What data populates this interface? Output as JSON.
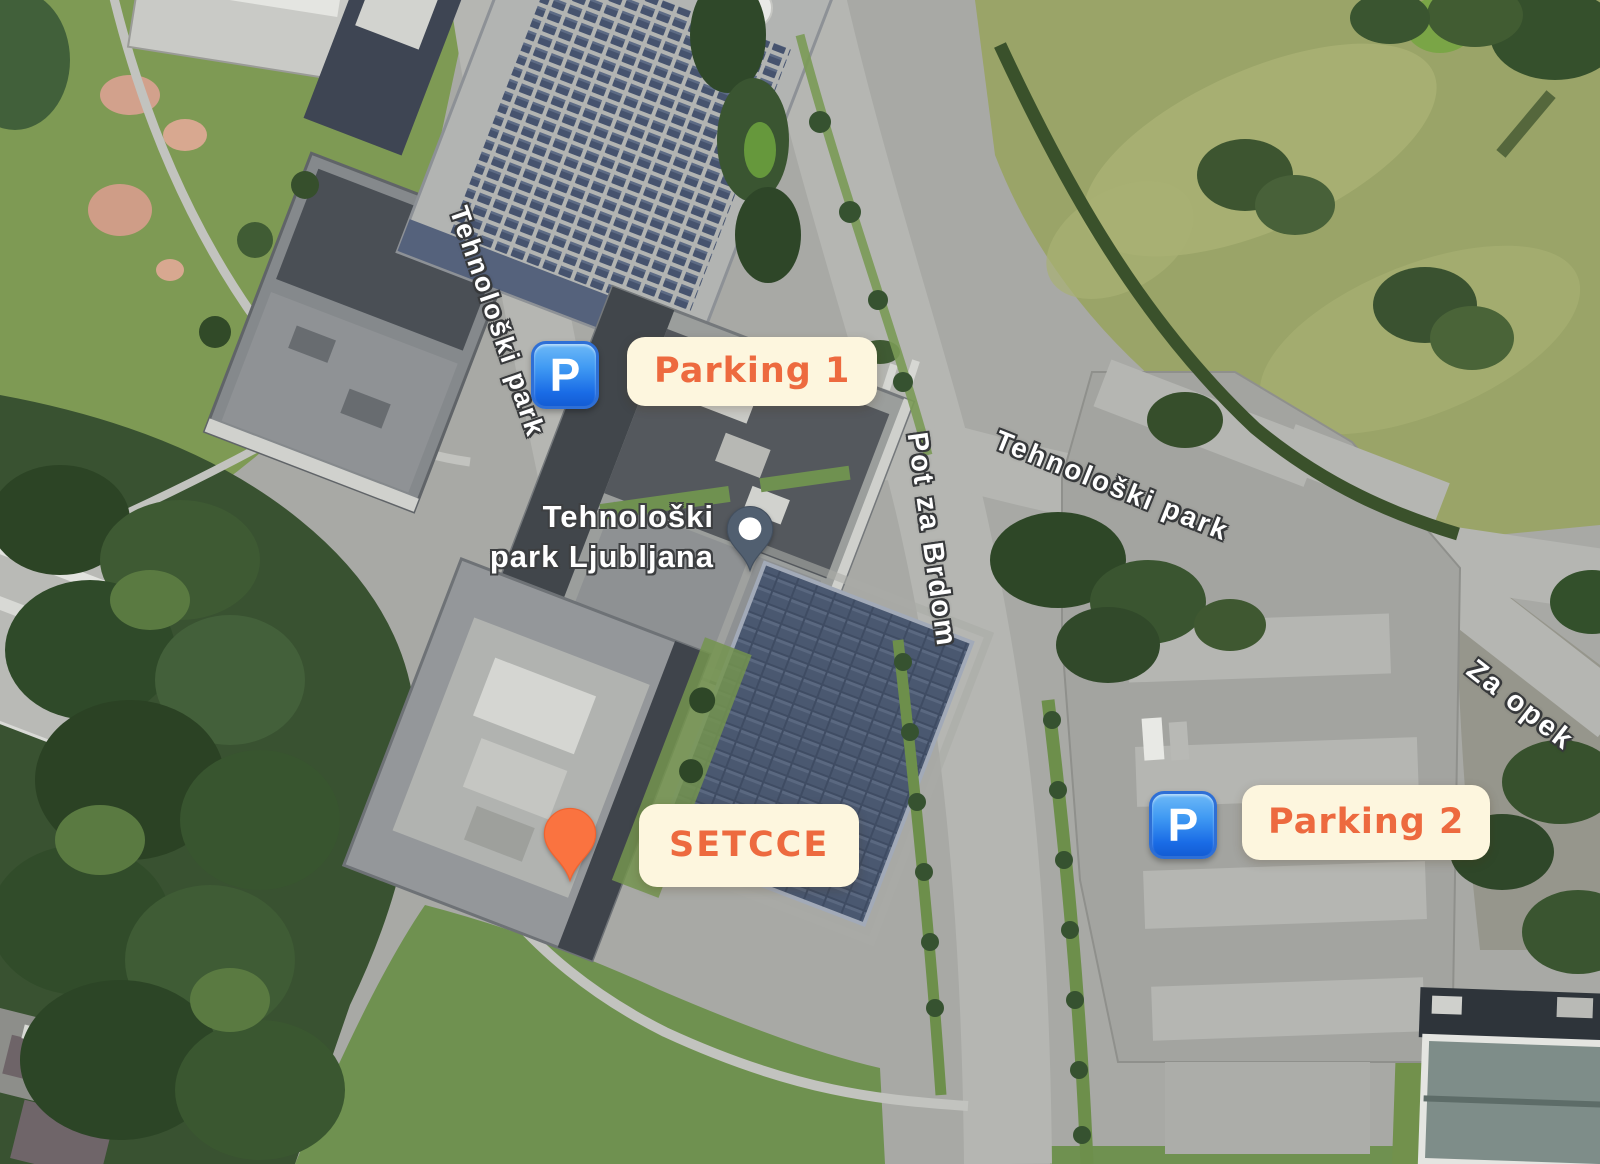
{
  "view": {
    "type": "satellite-map"
  },
  "markers": {
    "parking1": {
      "label": "Parking 1",
      "icon": "parking-emoji",
      "glyph": "P"
    },
    "parking2": {
      "label": "Parking 2",
      "icon": "parking-emoji",
      "glyph": "P"
    },
    "setcce": {
      "label": "SETCCE",
      "icon": "orange-pin"
    }
  },
  "poi": {
    "line1": "Tehnološki",
    "line2": "park Ljubljana"
  },
  "streets": [
    {
      "name": "Tehnološki park"
    },
    {
      "name": "Pot za Brdom"
    },
    {
      "name": "Tehnološki park"
    },
    {
      "name": "Za opek"
    }
  ],
  "colors": {
    "label_bg": "#fdf6de",
    "label_text": "#ed6a3f",
    "parking_blue": "#2f7fe8",
    "pin_orange": "#fa7340",
    "poi_pin_slate": "#515f70",
    "street_text": "#ffffff",
    "street_outline": "#37393b"
  }
}
